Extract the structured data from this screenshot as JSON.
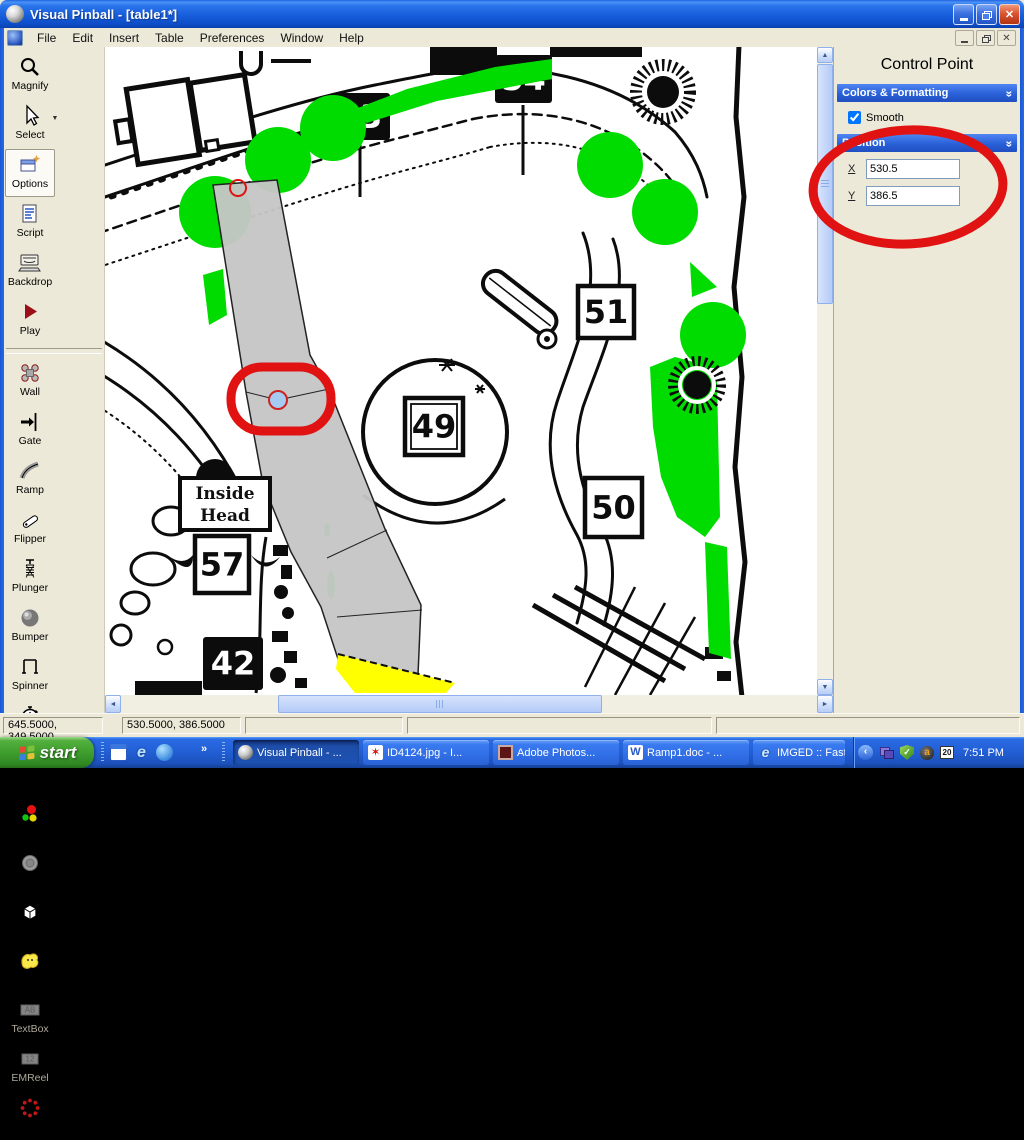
{
  "window": {
    "title": "Visual Pinball - [table1*]"
  },
  "menu": {
    "items": [
      "File",
      "Edit",
      "Insert",
      "Table",
      "Preferences",
      "Window",
      "Help"
    ]
  },
  "toolbar": {
    "tools": [
      {
        "label": "Magnify",
        "icon": "magnify"
      },
      {
        "label": "Select",
        "icon": "select",
        "dropdown": true
      },
      {
        "label": "Options",
        "icon": "options",
        "active": true
      },
      {
        "label": "Script",
        "icon": "script"
      },
      {
        "label": "Backdrop",
        "icon": "backdrop"
      },
      {
        "label": "Play",
        "icon": "play"
      },
      {
        "label": "Wall",
        "icon": "wall"
      },
      {
        "label": "Gate",
        "icon": "gate"
      },
      {
        "label": "Ramp",
        "icon": "ramp"
      },
      {
        "label": "Flipper",
        "icon": "flipper"
      },
      {
        "label": "Plunger",
        "icon": "plunger"
      },
      {
        "label": "Bumper",
        "icon": "bumper"
      },
      {
        "label": "Spinner",
        "icon": "spinner"
      },
      {
        "label": "Timer",
        "icon": "timer"
      },
      {
        "label": "Trigger",
        "icon": "trigger"
      },
      {
        "label": "Light",
        "icon": "light"
      },
      {
        "label": "Kicker",
        "icon": "kicker"
      },
      {
        "label": "Target",
        "icon": "target"
      },
      {
        "label": "Decal",
        "icon": "decal"
      },
      {
        "label": "TextBox",
        "icon": "textbox",
        "icon_text": "AB",
        "disabled": true
      },
      {
        "label": "EMReel",
        "icon": "emreel",
        "icon_text": "12",
        "disabled": true
      },
      {
        "label": "LightSeq",
        "icon": "lightseq"
      }
    ]
  },
  "canvas": {
    "signs": [
      {
        "text": "53",
        "style": "dark",
        "x": 225,
        "y": 46,
        "w": 60,
        "h": 47
      },
      {
        "text": "54",
        "style": "dark",
        "x": 390,
        "y": 8,
        "w": 57,
        "h": 48
      },
      {
        "text": "51",
        "style": "light",
        "x": 473,
        "y": 239,
        "w": 56,
        "h": 52
      },
      {
        "text": "49",
        "style": "light-double",
        "x": 300,
        "y": 351,
        "w": 58,
        "h": 57
      },
      {
        "text": "50",
        "style": "light",
        "x": 480,
        "y": 431,
        "w": 57,
        "h": 59
      },
      {
        "text": "57",
        "style": "light",
        "x": 90,
        "y": 489,
        "w": 54,
        "h": 57
      },
      {
        "text": "42",
        "style": "dark",
        "x": 98,
        "y": 590,
        "w": 60,
        "h": 53
      }
    ],
    "label_sign": {
      "lines": [
        "Inside",
        "Head"
      ],
      "x": 75,
      "y": 431,
      "w": 90,
      "h": 52
    },
    "annotation_color": "#e01212",
    "tree_color": "#00dc00",
    "ramp_color": "#c6c6c6",
    "highlight_color": "#ffff00"
  },
  "panel": {
    "title": "Control Point",
    "sections": [
      {
        "label": "Colors & Formatting"
      },
      {
        "label": "Position"
      }
    ],
    "smooth_label": "Smooth",
    "x_label": "X",
    "y_label": "Y",
    "x_value": "530.5",
    "y_value": "386.5"
  },
  "statusbar": {
    "cells": [
      "645.5000, 349.5000",
      "530.5000, 386.5000",
      "",
      "",
      ""
    ]
  },
  "taskbar": {
    "start_label": "start",
    "quick_launch_overflow": "»",
    "tasks": [
      {
        "label": "Visual Pinball - ...",
        "icon": "sphere",
        "active": true
      },
      {
        "label": "ID4124.jpg - I...",
        "icon": "splat",
        "active": false
      },
      {
        "label": "Adobe Photos...",
        "icon": "adobe",
        "active": false
      },
      {
        "label": "Ramp1.doc - ...",
        "icon": "word",
        "active": false
      },
      {
        "label": "IMGED :: Fast ...",
        "icon": "ie",
        "active": false
      }
    ],
    "tray": {
      "time": "7:51 PM",
      "date": "20"
    }
  }
}
